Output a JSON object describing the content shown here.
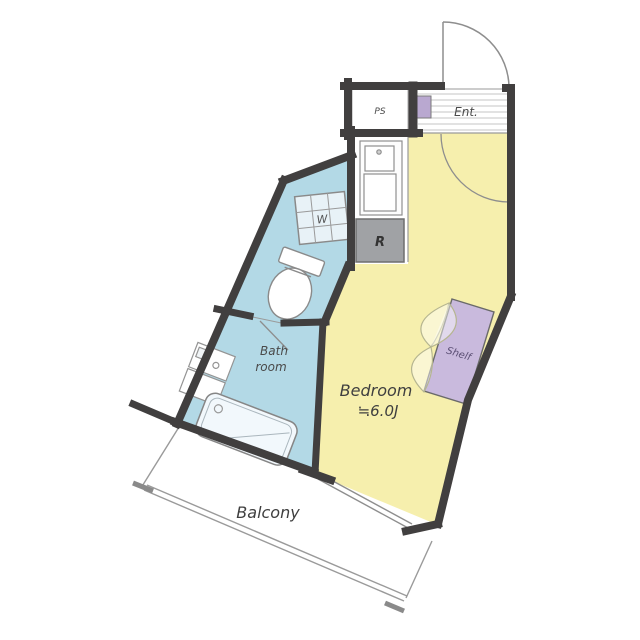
{
  "floorplan": {
    "type": "apartment-floor-plan",
    "labels": {
      "ps": "PS",
      "entry": "Ent.",
      "refrigerator": "R",
      "washer": "W",
      "bathroom_line1": "Bath",
      "bathroom_line2": "room",
      "bedroom": "Bedroom",
      "bedroom_size": "≒6.0J",
      "shelf": "Shelf",
      "balcony": "Balcony"
    },
    "colors": {
      "wall": "#413f3f",
      "bedroom_fill": "#f6efad",
      "sanitary_fill": "#b3d9e6",
      "washer_pan_fill": "#e8f2f7",
      "shelf_fill": "#c9badd",
      "refrigerator_fill": "#a0a2a5",
      "entry_meter_box": "#b9a8d0",
      "thin_line": "#8e8e8e",
      "hatch_line": "#c4c4c4",
      "label_text": "#4a4a4a"
    }
  }
}
